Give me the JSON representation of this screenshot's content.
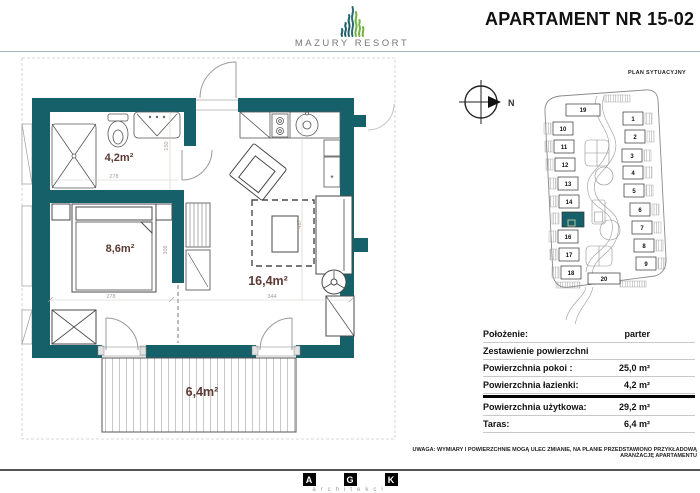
{
  "header": {
    "brand": "MAZURY RESORT",
    "title": "APARTAMENT NR 15-02",
    "accent_color": "#16606a",
    "logo_green": "#74b33e"
  },
  "plan": {
    "rooms": {
      "bathroom": "4,2m²",
      "bedroom": "8,6m²",
      "living": "16,4m²",
      "terrace": "6,4m²"
    },
    "dims": {
      "bathroom_w": "278",
      "bathroom_d": "150",
      "bedroom_w": "278",
      "bedroom_d": "309",
      "living_w": "344",
      "living_d": "487"
    },
    "boiler_symbol": "*",
    "label_color": "#5c3a34"
  },
  "site": {
    "label": "PLAN SYTUACYJNY",
    "compass": "N",
    "highlighted_building": "15",
    "highlight_color": "#16606a",
    "buildings": [
      {
        "n": "1"
      },
      {
        "n": "2"
      },
      {
        "n": "3"
      },
      {
        "n": "4"
      },
      {
        "n": "5"
      },
      {
        "n": "6"
      },
      {
        "n": "7"
      },
      {
        "n": "8"
      },
      {
        "n": "9"
      },
      {
        "n": "10"
      },
      {
        "n": "11"
      },
      {
        "n": "12"
      },
      {
        "n": "13"
      },
      {
        "n": "14"
      },
      {
        "n": "15"
      },
      {
        "n": "16"
      },
      {
        "n": "17"
      },
      {
        "n": "18"
      },
      {
        "n": "19"
      },
      {
        "n": "20"
      }
    ]
  },
  "info": {
    "rows": [
      {
        "label": "Położenie:",
        "value": "parter"
      },
      {
        "label": "Zestawienie powierzchni",
        "value": ""
      },
      {
        "label": "Powierzchnia pokoi :",
        "value": "25,0 m²"
      },
      {
        "label": "Powierzchnia łazienki:",
        "value": "4,2 m²"
      },
      {
        "label": "Powierzchnia użytkowa:",
        "value": "29,2 m²"
      },
      {
        "label": "Taras:",
        "value": "6,4 m²"
      }
    ]
  },
  "disclaimer": "UWAGA: WYMIARY I POWIERZCHNIE MOGĄ ULEC ZMIANIE, NA PLANIE PRZEDSTAWIONO PRZYKŁADOWĄ ARANŻACJĘ APARTAMENTU",
  "footer": {
    "letters": [
      "A",
      "G",
      "K"
    ],
    "subtitle": "architekci"
  }
}
